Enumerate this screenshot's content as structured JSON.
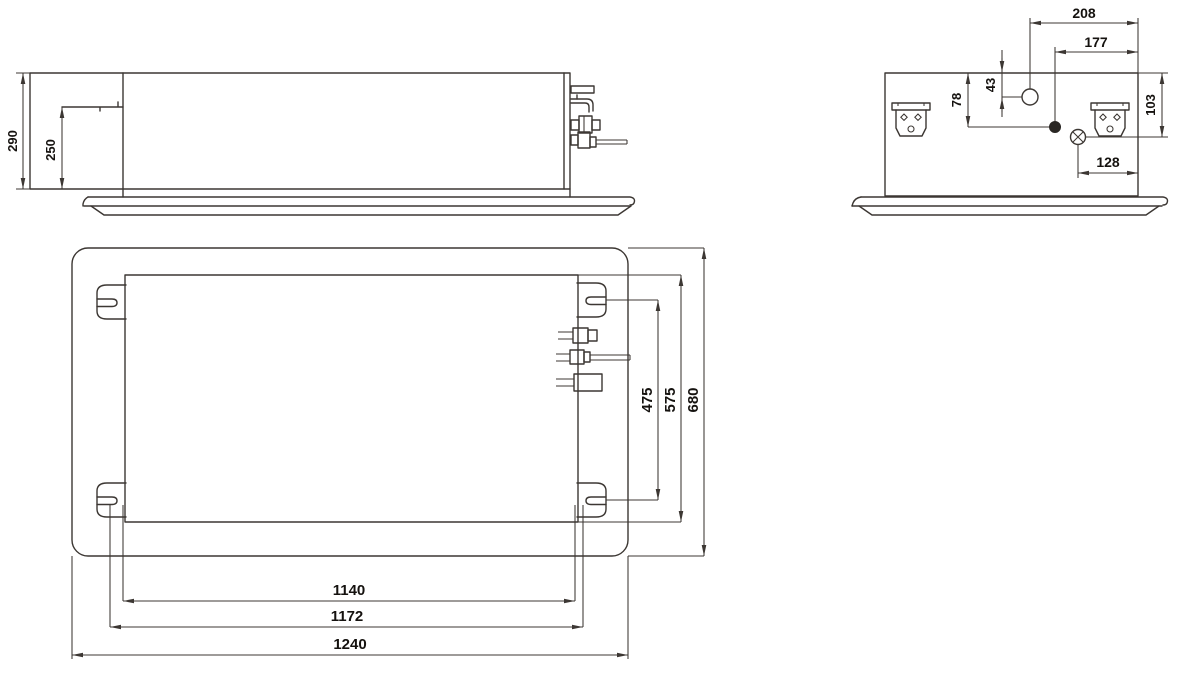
{
  "figure": {
    "type": "technical-dimension-drawing",
    "background": "#ffffff",
    "line_color": "#3c3733",
    "text_color": "#15120f"
  },
  "dimensions": {
    "front_view": {
      "overall_height": "290",
      "mount_line_height": "250"
    },
    "side_view": {
      "hole_a_offset": "208",
      "hole_b_offset": "177",
      "hole_a_drop": "43",
      "hole_b_drop": "78",
      "bolt_drop": "103",
      "bolt_offset": "128"
    },
    "plan_view": {
      "hanger_pitch_depth": "475",
      "body_depth": "575",
      "panel_depth": "680",
      "hanger_pitch_width": "1140",
      "body_width": "1172",
      "panel_width": "1240"
    }
  }
}
